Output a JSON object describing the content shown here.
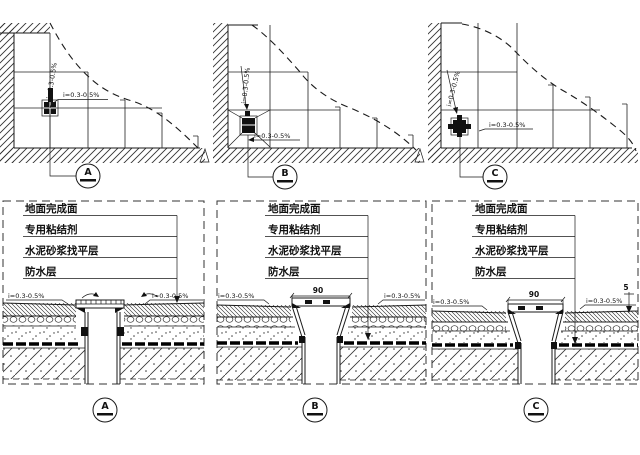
{
  "drawing": {
    "materials": [
      "地面完成面",
      "专用粘结剂",
      "水泥砂浆找平层",
      "防水层"
    ],
    "labels": {
      "slope": "i=0.3-0.5%",
      "dim_90": "90",
      "dim_5": "5"
    },
    "callouts": {
      "a": "A",
      "b": "B",
      "c": "C"
    },
    "colors": {
      "line": "#1a1a1a",
      "background": "#ffffff"
    }
  }
}
